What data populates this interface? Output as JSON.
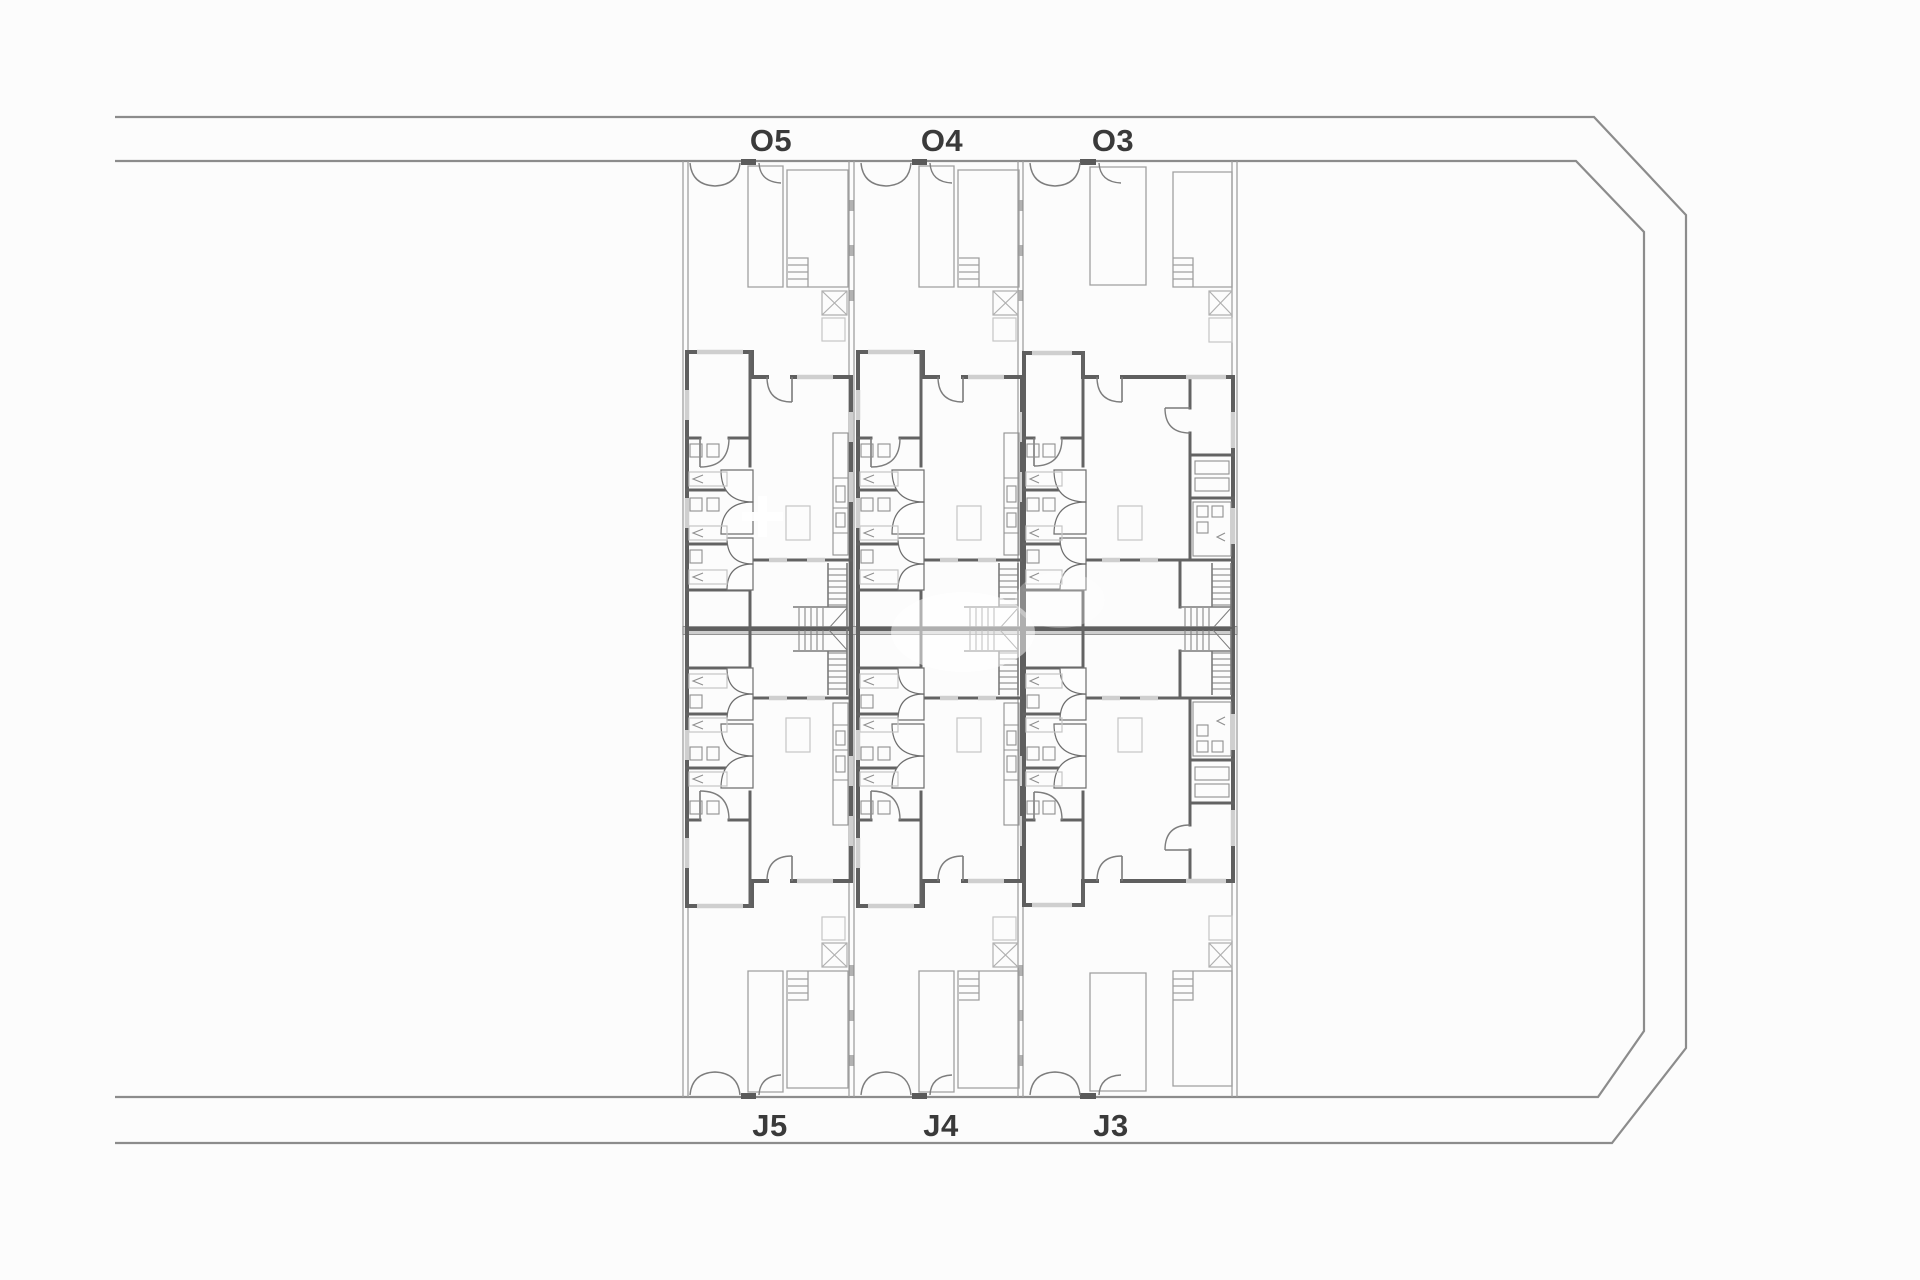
{
  "document": {
    "type": "architectural site floor plan",
    "background": "#fcfcfc"
  },
  "plan": {
    "top_row_labels": [
      {
        "label": "O5"
      },
      {
        "label": "O4"
      },
      {
        "label": "O3"
      }
    ],
    "bottom_row_labels": [
      {
        "label": "J5"
      },
      {
        "label": "J4"
      },
      {
        "label": "J3"
      }
    ],
    "colors": {
      "boundary_line": "#8c8c8c",
      "wall": "#5f5f5f",
      "plot_line": "#a3a3a3",
      "wall_fill": "#cdcdcd",
      "label_text": "#3a3a3a",
      "watermark": "#ffffff"
    }
  }
}
